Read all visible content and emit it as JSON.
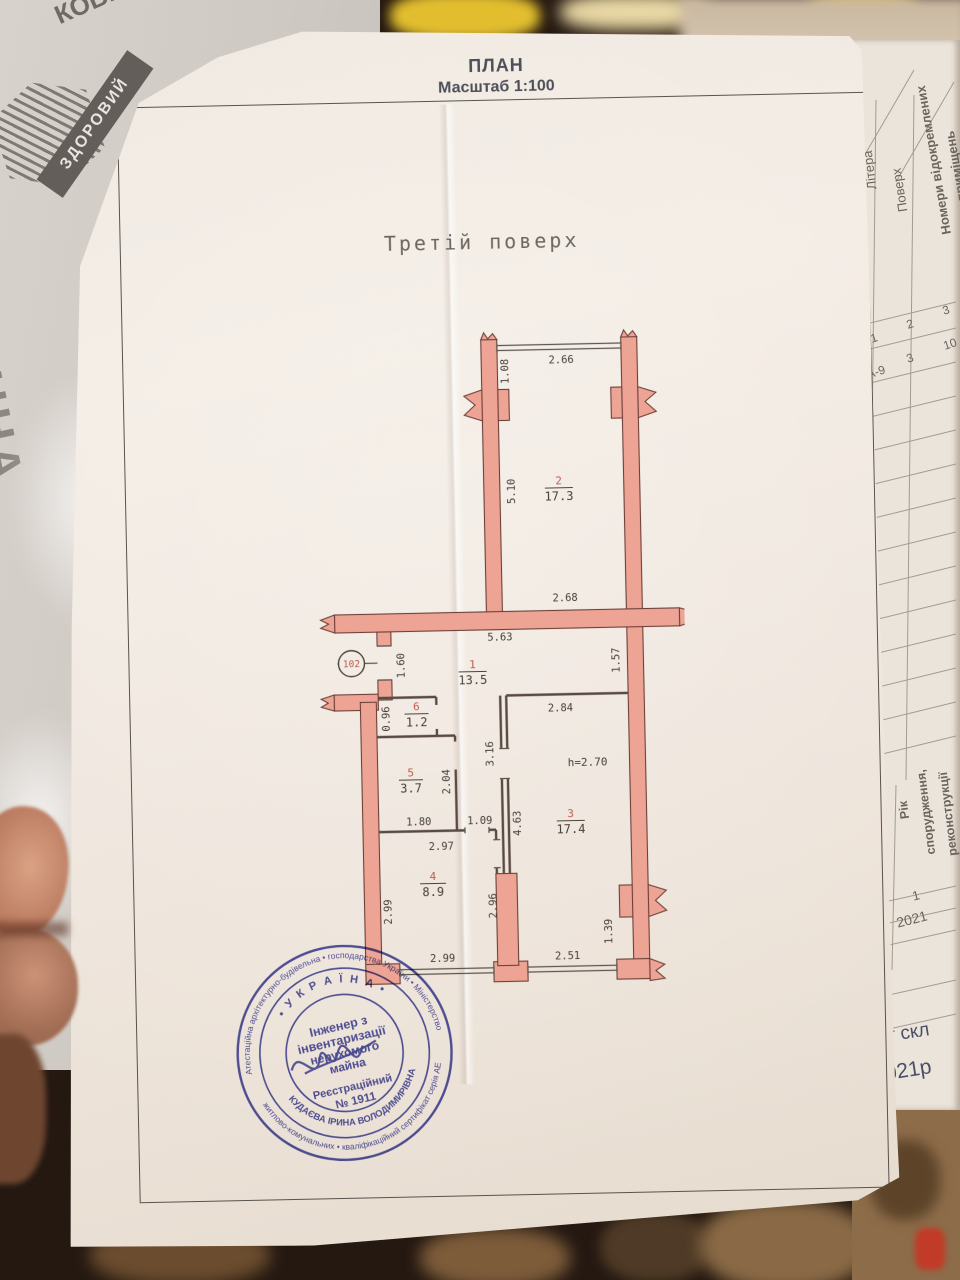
{
  "background": {
    "bag": {
      "ribbon_text": "ЗДОРОВИЙ",
      "brand_text": "РОДИННА",
      "brand_text2": "КОВБАСКИ"
    }
  },
  "side_page": {
    "header": {
      "col_litera": "Літера",
      "col_poverh": "Поверх",
      "col_nomery_line1": "Номери відокремлених",
      "col_nomery_line2": "приміщень"
    },
    "row_index": {
      "c1": "1",
      "c2": "2",
      "c3": "3"
    },
    "row_values": {
      "litera": "А-9",
      "poverh": "3",
      "nomery": "10"
    },
    "year_block": {
      "label_line1": "Рік",
      "label_line2": "спорудження,",
      "label_line3": "реконструкції",
      "index": "1",
      "value": "2021"
    },
    "bottom_fragment_line1": "орт скл",
    "bottom_fragment_line2": ".2021р"
  },
  "document": {
    "title": "ПЛАН",
    "scale": "Масштаб 1:100",
    "floor_label": "Третій поверх",
    "plan": {
      "rooms": [
        {
          "number": "2",
          "area": "17.3"
        },
        {
          "number": "1",
          "area": "13.5"
        },
        {
          "number": "6",
          "area": "1.2"
        },
        {
          "number": "5",
          "area": "3.7"
        },
        {
          "number": "4",
          "area": "8.9"
        },
        {
          "number": "3",
          "area": "17.4"
        }
      ],
      "height_note": "h=2.70",
      "entry_number": "102",
      "dims": {
        "d108": "1.08",
        "d266": "2.66",
        "d510": "5.10",
        "d268": "2.68",
        "d563": "5.63",
        "d160": "1.60",
        "d157": "1.57",
        "d284": "2.84",
        "d096": "0.96",
        "d316": "3.16",
        "d204": "2.04",
        "d180": "1.80",
        "d109": "1.09",
        "d463": "4.63",
        "d297": "2.97",
        "d299left": "2.99",
        "d296": "2.96",
        "d299bottom": "2.99",
        "d251": "2.51",
        "d139": "1.39"
      },
      "colors": {
        "wall_fill": "#eda495",
        "wall_stroke": "#6d4038",
        "room_number": "#bf5a4d",
        "dim_text": "#46403a"
      }
    },
    "stamp": {
      "center_line1": "Інженер з",
      "center_line2": "інвентаризації",
      "center_line3": "нерухомого",
      "center_line4": "майна",
      "center_line5": "Реєстраційний",
      "center_line6": "№ 1911",
      "inner_arc_top": "• У К Р А Ї Н А •",
      "inner_arc_bottom": "КУДАЄВА ІРИНА ВОЛОДИМИРІВНА",
      "outer_arc_top": "Атестаційна архітектурно-будівельна • господарства України • Міністерство",
      "outer_arc_bottom": "житлово-комунальних • кваліфікаційний сертифікат серія АЕ",
      "color": "#3b3e9d"
    }
  }
}
